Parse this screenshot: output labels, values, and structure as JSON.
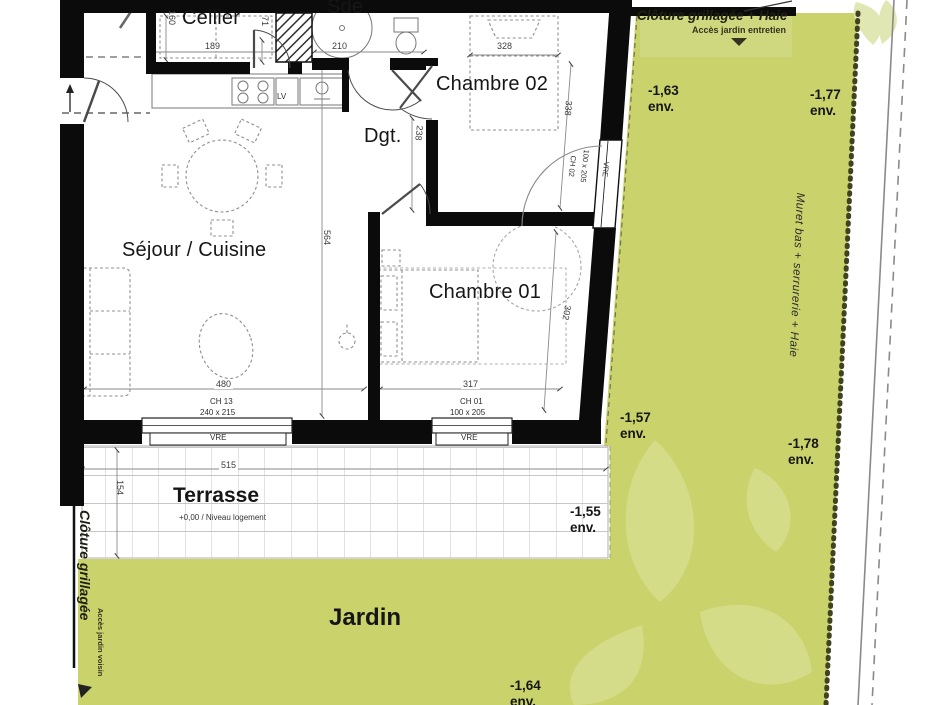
{
  "rooms": {
    "cellier": "Cellier",
    "sde": "Sde",
    "chambre02": "Chambre 02",
    "dgt": "Dgt.",
    "sejour": "Séjour / Cuisine",
    "chambre01": "Chambre 01",
    "terrasse": "Terrasse",
    "jardin": "Jardin"
  },
  "terrasse_note": "+0,00 / Niveau logement",
  "dims": {
    "cellier_w": "189",
    "cellier_h": "160",
    "cellier_door": "71",
    "sde_w": "210",
    "ch02_bed": "328",
    "ch02_depth": "338",
    "dgt_len": "238",
    "sejour_depth": "564",
    "sejour_w": "480",
    "ch01_w": "317",
    "ch01_depth": "302",
    "terrasse_w": "515",
    "terrasse_d": "154"
  },
  "openings": {
    "sejour_tag": "CH 13",
    "sejour_size": "240 x 215",
    "ch01_tag": "CH 01",
    "ch01_size": "100 x 205",
    "ch02_tag": "CH 02",
    "ch02_size": "100 x 205",
    "shutter": "VRE",
    "kitchen_dw": "LV"
  },
  "levels": {
    "l163": {
      "v": "-1,63",
      "u": "env."
    },
    "l177": {
      "v": "-1,77",
      "u": "env."
    },
    "l157": {
      "v": "-1,57",
      "u": "env."
    },
    "l178": {
      "v": "-1,78",
      "u": "env."
    },
    "l155": {
      "v": "-1,55",
      "u": "env."
    },
    "l164": {
      "v": "-1,64",
      "u": "env."
    }
  },
  "annotations": {
    "fence_top": "Clôture grillagée + Haie",
    "access_top": "Accès jardin entretien",
    "fence_left": "Clôture grillagée",
    "access_left": "Accès jardin voisin",
    "wall_right": "Muret bas + serrurerie + Haie"
  },
  "colors": {
    "garden": "#c9d26b",
    "leaf": "#d6de8e",
    "wall": "#0b0b0b",
    "terrace_grid": "#c6c6c6"
  }
}
